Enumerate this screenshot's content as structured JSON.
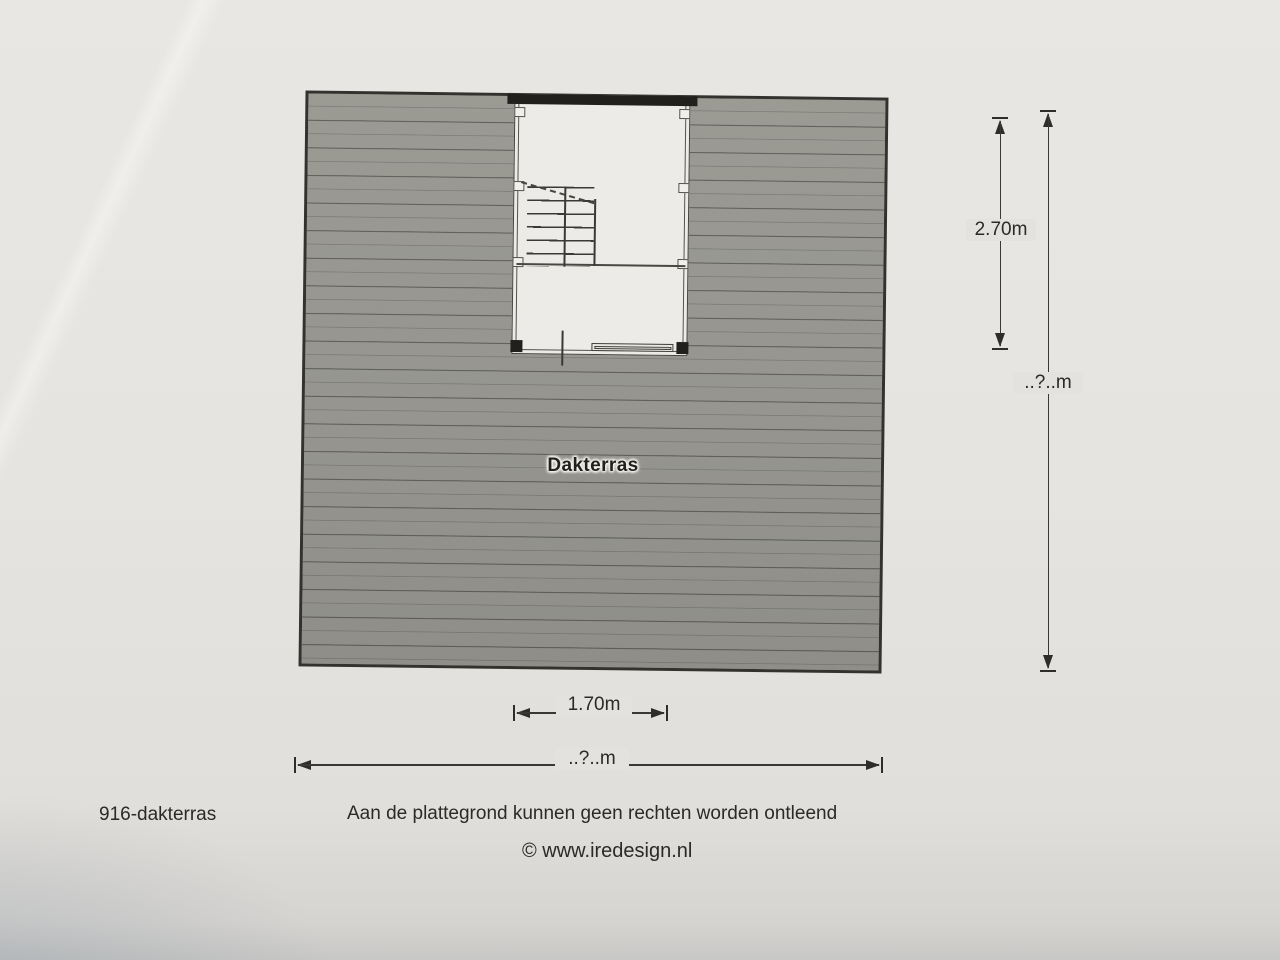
{
  "plan": {
    "area_label": "Dakterras",
    "dimensions": {
      "opening_depth": "2.70m",
      "terrace_depth": "..?..m",
      "opening_width": "1.70m",
      "terrace_width": "..?..m"
    },
    "footer": {
      "drawing_id": "916-dakterras",
      "disclaimer": "Aan de plattegrond kunnen geen rechten worden ontleend",
      "copyright": "© www.iredesign.nl"
    }
  }
}
